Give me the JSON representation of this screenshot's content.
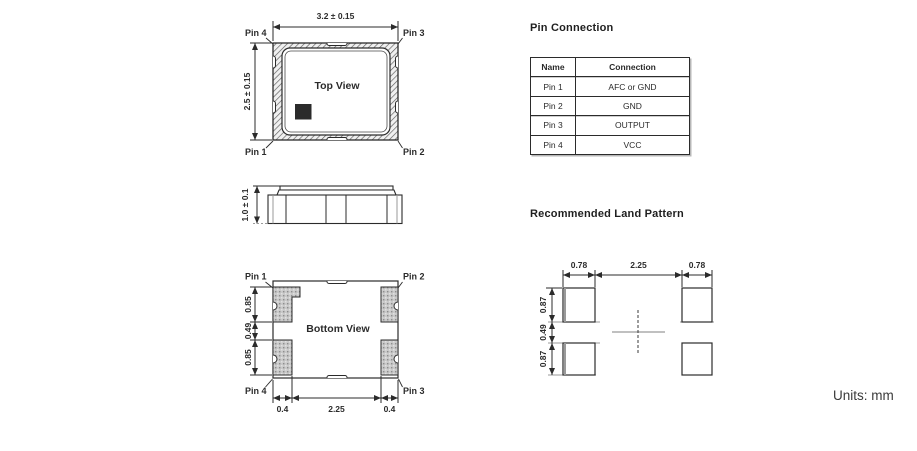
{
  "page": {
    "units_label": "Units: mm",
    "ink_color": "#2b2b2b"
  },
  "top_view": {
    "label": "Top View",
    "width_dim": "3.2 ± 0.15",
    "height_dim": "2.5 ± 0.15",
    "pin_top_left": "Pin 4",
    "pin_top_right": "Pin 3",
    "pin_bottom_left": "Pin 1",
    "pin_bottom_right": "Pin 2"
  },
  "side_view": {
    "height_dim": "1.0 ± 0.1"
  },
  "bottom_view": {
    "label": "Bottom View",
    "pin_top_left": "Pin 1",
    "pin_top_right": "Pin 2",
    "pin_bottom_left": "Pin 4",
    "pin_bottom_right": "Pin 3",
    "left_dims": [
      "0.85",
      "0.49",
      "0.85"
    ],
    "bottom_dims": [
      "0.4",
      "2.25",
      "0.4"
    ]
  },
  "pin_connection": {
    "title": "Pin Connection",
    "headers": [
      "Name",
      "Connection"
    ],
    "rows": [
      [
        "Pin 1",
        "AFC or GND"
      ],
      [
        "Pin 2",
        "GND"
      ],
      [
        "Pin 3",
        "OUTPUT"
      ],
      [
        "Pin 4",
        "VCC"
      ]
    ]
  },
  "land_pattern": {
    "title": "Recommended Land Pattern",
    "top_dims": [
      "0.78",
      "2.25",
      "0.78"
    ],
    "left_dims": [
      "0.87",
      "0.49",
      "0.87"
    ]
  }
}
